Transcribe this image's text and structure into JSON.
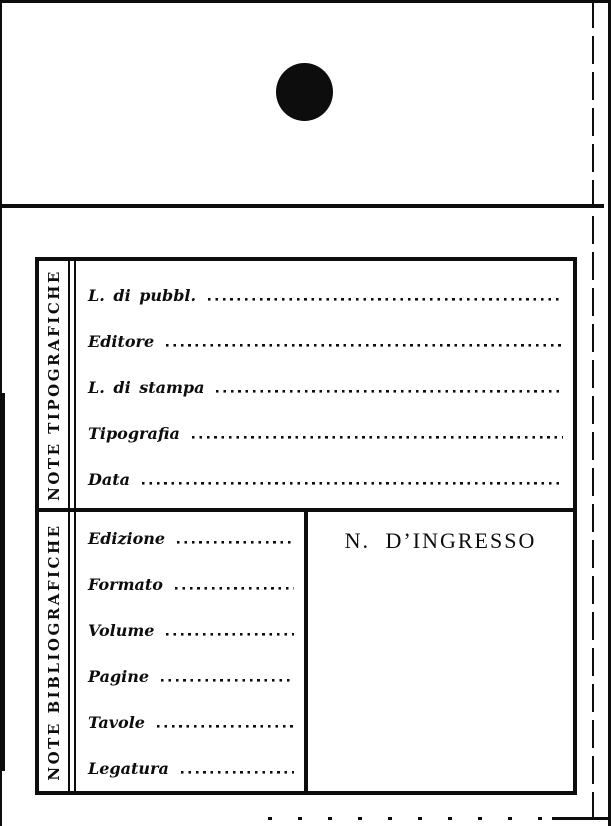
{
  "colors": {
    "ink": "#0d0d0d",
    "paper": "#ffffff"
  },
  "icons": {
    "punch_hole": "filled-circle"
  },
  "card": {
    "typographic_section": {
      "side_label": "NOTE TIPOGRAFICHE",
      "fields": [
        {
          "label": "L. di pubbl.",
          "value": ""
        },
        {
          "label": "Editore",
          "value": ""
        },
        {
          "label": "L. di stampa",
          "value": ""
        },
        {
          "label": "Tipografia",
          "value": ""
        },
        {
          "label": "Data",
          "value": ""
        }
      ]
    },
    "bibliographic_section": {
      "side_label": "NOTE BIBLIOGRAFICHE",
      "fields": [
        {
          "label": "Edizione",
          "value": ""
        },
        {
          "label": "Formato",
          "value": ""
        },
        {
          "label": "Volume",
          "value": ""
        },
        {
          "label": "Pagine",
          "value": ""
        },
        {
          "label": "Tavole",
          "value": ""
        },
        {
          "label": "Legatura",
          "value": ""
        }
      ],
      "ingresso_box": {
        "label": "N. D’INGRESSO",
        "value": ""
      }
    }
  }
}
